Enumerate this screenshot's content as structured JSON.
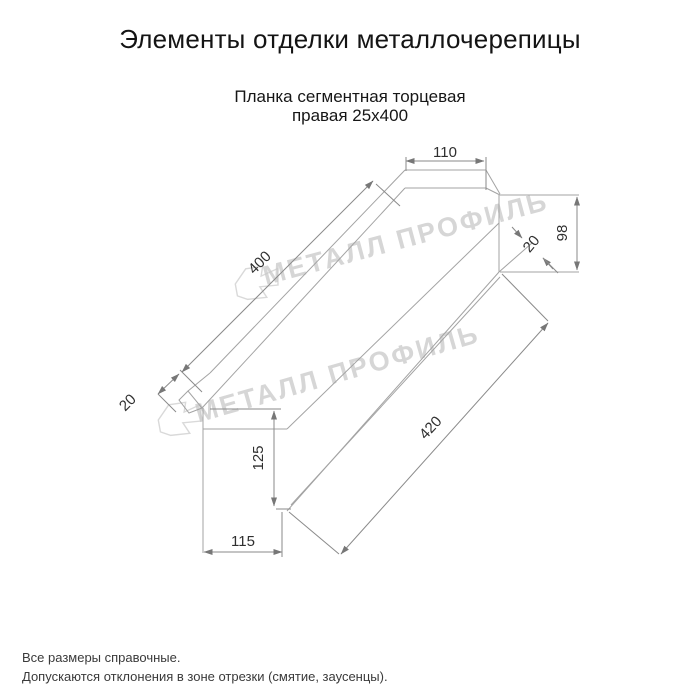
{
  "title": "Элементы отделки металлочерепицы",
  "subtitle": {
    "line1": "Планка сегментная торцевая",
    "line2": "правая 25x400"
  },
  "drawing": {
    "dims": {
      "top_width": "110",
      "right_height": "98",
      "right_bevel": "20",
      "top_edge": "400",
      "left_bevel": "20",
      "front_height": "125",
      "bottom_width": "115",
      "bottom_edge": "420"
    },
    "watermark_text": "МЕТАЛЛ ПРОФИЛЬ"
  },
  "footer": {
    "note1": "Все размеры справочные.",
    "note2": "Допускаются отклонения в зоне отрезки (смятие, заусенцы)."
  },
  "colors": {
    "background": "#ffffff",
    "part_line": "#a3a3a3",
    "dimension_line": "#8a8a8a",
    "dimension_text": "#2f2f2f",
    "watermark": "#c9c9c9",
    "title_text": "#141414"
  }
}
